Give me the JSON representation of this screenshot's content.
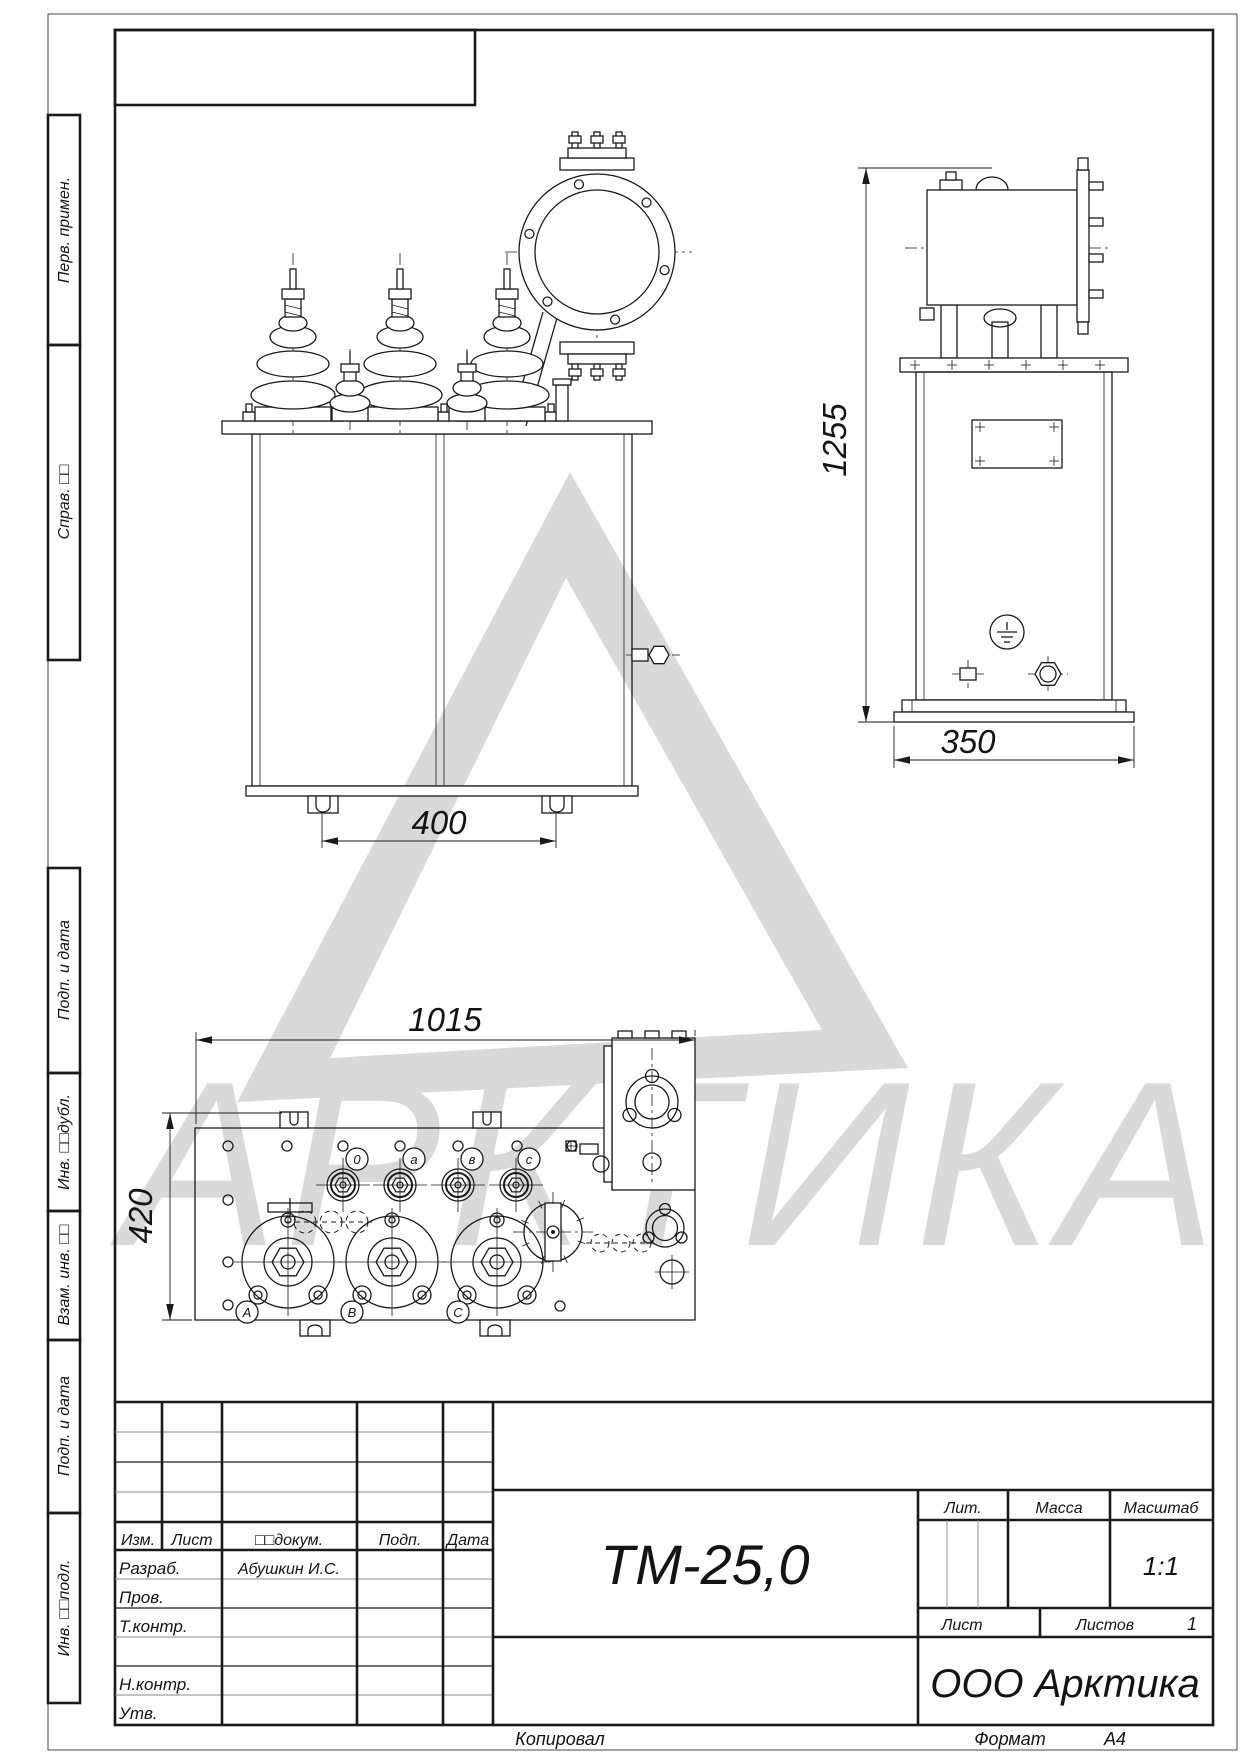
{
  "stamps": {
    "items": [
      "Перв. примен.",
      "Справ. □□",
      "Подп. и дата",
      "Инв. □□дубл.",
      "Взам. инв. □□",
      "Подп. и дата",
      "Инв. □□подл."
    ]
  },
  "title_block": {
    "header_columns": [
      "Изм.",
      "Лист",
      "□□докум.",
      "Подп.",
      "Дата"
    ],
    "sign_rows": [
      {
        "label": "Разраб.",
        "name": "Абушкин И.С."
      },
      {
        "label": "Пров.",
        "name": ""
      },
      {
        "label": "Т.контр.",
        "name": ""
      },
      {
        "label": "Н.контр.",
        "name": ""
      },
      {
        "label": "Утв.",
        "name": ""
      }
    ],
    "designation": "ТМ-25,0",
    "lit_label": "Лит.",
    "mass_label": "Масса",
    "scale_label": "Масштаб",
    "scale_value": "1:1",
    "sheet_label": "Лист",
    "sheets_label": "Листов",
    "sheets_value": "1",
    "company": "ООО Арктика"
  },
  "footer": {
    "copied_label": "Копировал",
    "format_label": "Формат",
    "format_value": "А4"
  },
  "watermark": {
    "text": "АРКТИКА",
    "color": "#d9d9d9"
  },
  "dimensions": {
    "plan_width": "1015",
    "plan_depth": "420",
    "front_width": "400",
    "side_width": "350",
    "height": "1255"
  },
  "plan_labels": {
    "hv_phases": [
      "А",
      "В",
      "С"
    ],
    "lv_terminals": [
      "0",
      "а",
      "в",
      "с"
    ]
  }
}
